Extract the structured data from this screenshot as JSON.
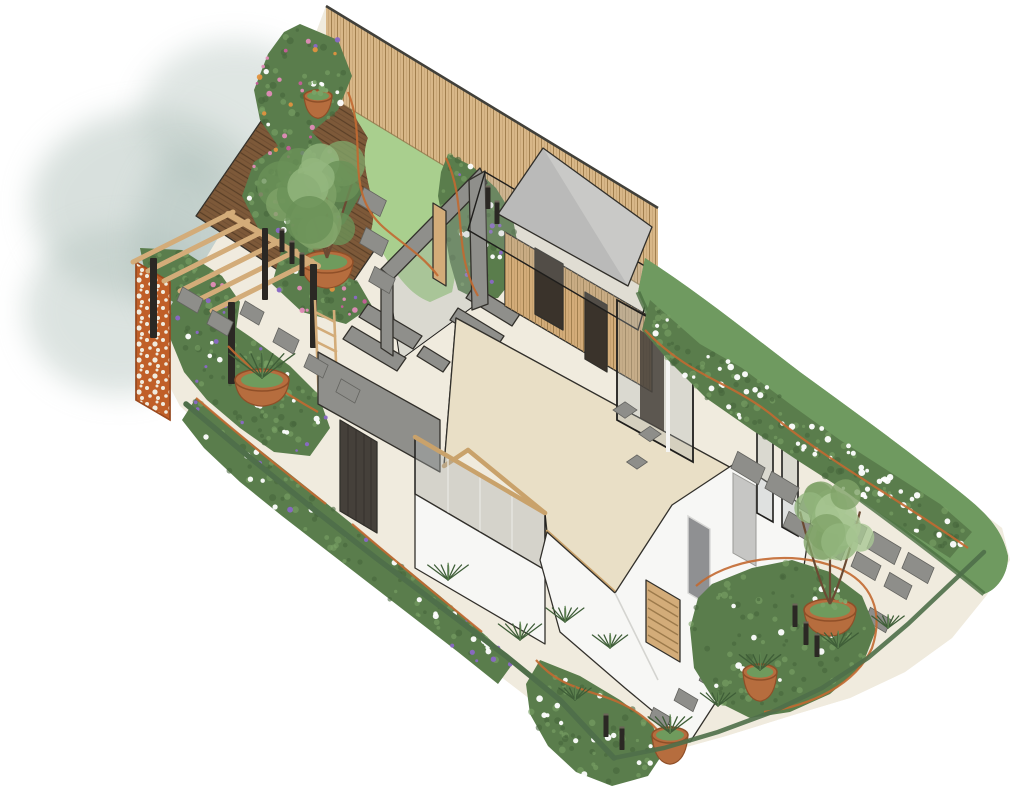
{
  "meta": {
    "title": "Axonometric garden design illustration",
    "alt": "Hand-rendered axonometric landscape plan of a long rectangular show garden with a cutaway house, herringbone-paved interior floor, timber garden building with grey canopy, timber slat fence, decked corner with pergola and corten screen, lawn, gravel paths with grey pavers, planting beds of pink, purple and white flowers, terracotta pots and a long clipped hedge"
  },
  "palette": {
    "bg": "#ffffff",
    "wash": "#b9c8c2",
    "washDark": "#9db3ad",
    "gravel": "#f0ebde",
    "speck": "#c9b795",
    "deck": "#7d5939",
    "deckLine": "#5a3f27",
    "lawn": "#a9cf8e",
    "lawnDot": "#8abc6e",
    "lawnLight": "#c8e4ab",
    "fence": "#d8b788",
    "fenceLine": "#a2804f",
    "fenceCap": "#41403a",
    "herr": "#e9dfc6",
    "herrLine": "#b2a185",
    "floorEdge": "#c9a26b",
    "white": "#f7f7f5",
    "whiteShade": "#e9e9e6",
    "outline": "#32302b",
    "gray": "#8f8f8b",
    "grayDark": "#6f6f6b",
    "darkSlat": "#45403a",
    "glass": "#a8aeae",
    "glassFrame": "#1f1e1c",
    "canopy": "#c9c9c7",
    "timber": "#d3ac79",
    "timberLine": "#9c7a4b",
    "darkDoor": "#3a332b",
    "corten": "#c05f28",
    "cortenDark": "#9c4a1e",
    "hedge": "#6f9a60",
    "hedgeDark": "#4b7042",
    "hedgeLight": "#8db377",
    "bedBase": "#5a7d4c",
    "bedDark": "#46663c",
    "bedLight": "#79a266",
    "flowerPink": "#e18cb7",
    "flowerMagenta": "#c75d99",
    "flowerPurple": "#8a68c6",
    "flowerWhite": "#ffffff",
    "flowerOrange": "#e0923f",
    "terracotta": "#b66d3e",
    "terraDark": "#8f4f28",
    "potGreen": "#6f9b5d",
    "paver": "#8e8e8a",
    "paverEdge": "#63635f",
    "bollard": "#2b2824",
    "trunk": "#6b4a33",
    "tuft": "#3f5e38",
    "edging": "#c36a31",
    "boundary": "#4f6f4a",
    "tree1": "#6a9157",
    "tree2": "#7fa268",
    "tree3": "#94b77e",
    "tree4": "#a9c793"
  },
  "scene": {
    "beds": [
      {
        "name": "bed-top-left",
        "layer": "beds-back",
        "seed": 7,
        "mottle": 130,
        "points": "300,24 338,40 352,76 338,110 312,132 340,162 362,192 344,224 308,240 322,266 358,282 372,306 346,324 302,312 272,284 282,248 258,228 242,196 254,162 278,146 260,120 254,90 268,54 284,32",
        "flowers": [
          [
            "flowerPink",
            26
          ],
          [
            "flowerMagenta",
            14
          ],
          [
            "flowerPurple",
            12
          ],
          [
            "flowerOrange",
            10
          ],
          [
            "flowerWhite",
            12
          ]
        ]
      },
      {
        "name": "bed-fence",
        "layer": "beds-back",
        "seed": 12,
        "mottle": 46,
        "points": "448,154 472,166 496,188 512,214 518,246 514,278 498,298 478,300 458,290 450,262 444,228 438,196 441,172",
        "flowers": [
          [
            "flowerPurple",
            14
          ],
          [
            "flowerWhite",
            10
          ]
        ]
      },
      {
        "name": "bed-climber",
        "layer": "beds-back",
        "seed": 3,
        "mottle": 46,
        "points": "140,248 182,250 222,276 240,302 236,330 206,322 170,300 146,278",
        "flowers": [
          [
            "flowerPink",
            5
          ],
          [
            "flowerPurple",
            4
          ]
        ]
      },
      {
        "name": "bed-left",
        "layer": "beds-back",
        "seed": 21,
        "mottle": 76,
        "points": "178,294 214,312 252,338 290,366 318,394 330,428 310,456 274,452 240,428 207,400 184,372 170,338 168,310",
        "flowers": [
          [
            "flowerPurple",
            16
          ],
          [
            "flowerWhite",
            14
          ]
        ]
      },
      {
        "name": "bed-bottom-left",
        "layer": "beds-front",
        "seed": 31,
        "mottle": 64,
        "points": "196,398 232,428 270,458 310,490 352,524 396,560 440,596 484,634 514,662 498,684 458,652 414,618 370,584 326,550 282,516 240,482 204,448 182,420",
        "flowers": [
          [
            "flowerWhite",
            18
          ],
          [
            "flowerPurple",
            12
          ]
        ]
      },
      {
        "name": "bed-bottom-center",
        "layer": "beds-front",
        "seed": 41,
        "mottle": 52,
        "points": "540,660 580,676 620,700 652,724 664,752 648,776 612,786 576,772 548,746 530,714 526,684",
        "flowers": [
          [
            "flowerWhite",
            16
          ]
        ]
      },
      {
        "name": "bed-right-hedge",
        "layer": "beds-right",
        "seed": 55,
        "mottle": 110,
        "points": "650,300 700,344 742,368 790,404 840,440 890,472 940,504 972,532 950,558 900,526 850,494 800,462 752,430 706,398 668,360 642,330",
        "flowers": [
          [
            "flowerWhite",
            64
          ]
        ]
      },
      {
        "name": "bed-right-lower",
        "layer": "beds-front",
        "seed": 61,
        "mottle": 88,
        "points": "712,584 752,568 792,560 830,572 862,596 876,630 862,666 830,694 790,712 750,718 714,700 694,668 690,628 698,598",
        "flowers": [
          [
            "flowerWhite",
            12
          ]
        ]
      }
    ],
    "trees": [
      {
        "name": "multi-stem-tree-left",
        "layer": "trees-back",
        "cx": 325,
        "cy": 194,
        "r": 57,
        "seed": 9,
        "colors": [
          "tree1",
          "tree2",
          "tree3"
        ],
        "trunkBase": [
          327,
          258
        ],
        "spread": 26
      },
      {
        "name": "multi-stem-tree-right",
        "layer": "trees-front",
        "cx": 832,
        "cy": 523,
        "r": 46,
        "seed": 17,
        "colors": [
          "tree2",
          "tree3",
          "tree4"
        ],
        "trunkBase": [
          830,
          604
        ],
        "spread": 30
      }
    ],
    "pots": [
      {
        "name": "tree-pot-left",
        "layer": "pots-back",
        "cx": 327,
        "cy": 262,
        "rx": 26,
        "ry": 11,
        "plant": "none",
        "type": "bowl"
      },
      {
        "name": "grass-pot-pergola",
        "layer": "pots-front",
        "cx": 262,
        "cy": 380,
        "rx": 27,
        "ry": 11,
        "plant": "grass",
        "type": "bowl"
      },
      {
        "name": "perennial-bowl-right",
        "layer": "pots-front",
        "cx": 830,
        "cy": 610,
        "rx": 26,
        "ry": 11,
        "plant": "perennial",
        "type": "bowl"
      },
      {
        "name": "grass-pot-right",
        "layer": "pots-front",
        "cx": 760,
        "cy": 672,
        "rx": 17,
        "ry": 8,
        "plant": "grass",
        "type": "tall"
      },
      {
        "name": "grass-pot-bottom",
        "layer": "pots-front",
        "cx": 670,
        "cy": 735,
        "rx": 18,
        "ry": 8,
        "plant": "grass",
        "type": "tall"
      },
      {
        "name": "flower-pot-fence-tip",
        "layer": "pots-back",
        "cx": 318,
        "cy": 96,
        "rx": 14,
        "ry": 6,
        "plant": "perennial",
        "type": "tall"
      }
    ],
    "pavers": [
      {
        "cx": 190,
        "cy": 300,
        "w": 24,
        "h": 15,
        "t": "u"
      },
      {
        "cx": 220,
        "cy": 323,
        "w": 24,
        "h": 15,
        "t": "u"
      },
      {
        "cx": 252,
        "cy": 313,
        "w": 22,
        "h": 14,
        "t": "u"
      },
      {
        "cx": 286,
        "cy": 341,
        "w": 24,
        "h": 15,
        "t": "u"
      },
      {
        "cx": 316,
        "cy": 366,
        "w": 22,
        "h": 14,
        "t": "u"
      },
      {
        "cx": 348,
        "cy": 391,
        "w": 22,
        "h": 14,
        "t": "u"
      },
      {
        "cx": 372,
        "cy": 202,
        "w": 26,
        "h": 17,
        "t": "u"
      },
      {
        "cx": 374,
        "cy": 242,
        "w": 26,
        "h": 17,
        "t": "u"
      },
      {
        "cx": 382,
        "cy": 280,
        "w": 24,
        "h": 16,
        "t": "u"
      },
      {
        "cx": 625,
        "cy": 410,
        "w": 15,
        "h": 15,
        "t": "d"
      },
      {
        "cx": 650,
        "cy": 434,
        "w": 14,
        "h": 14,
        "t": "d"
      },
      {
        "cx": 637,
        "cy": 462,
        "w": 13,
        "h": 13,
        "t": "d"
      },
      {
        "cx": 748,
        "cy": 468,
        "w": 32,
        "h": 18,
        "t": "u"
      },
      {
        "cx": 782,
        "cy": 488,
        "w": 32,
        "h": 18,
        "t": "u"
      },
      {
        "cx": 816,
        "cy": 508,
        "w": 32,
        "h": 18,
        "t": "u"
      },
      {
        "cx": 850,
        "cy": 528,
        "w": 32,
        "h": 18,
        "t": "u"
      },
      {
        "cx": 884,
        "cy": 548,
        "w": 32,
        "h": 18,
        "t": "u"
      },
      {
        "cx": 918,
        "cy": 568,
        "w": 30,
        "h": 17,
        "t": "u"
      },
      {
        "cx": 798,
        "cy": 526,
        "w": 28,
        "h": 16,
        "t": "u"
      },
      {
        "cx": 832,
        "cy": 546,
        "w": 28,
        "h": 16,
        "t": "u"
      },
      {
        "cx": 866,
        "cy": 566,
        "w": 28,
        "h": 16,
        "t": "u"
      },
      {
        "cx": 898,
        "cy": 586,
        "w": 26,
        "h": 15,
        "t": "u"
      },
      {
        "cx": 846,
        "cy": 604,
        "w": 26,
        "h": 15,
        "t": "u"
      },
      {
        "cx": 878,
        "cy": 620,
        "w": 24,
        "h": 14,
        "t": "u"
      },
      {
        "cx": 737,
        "cy": 658,
        "w": 24,
        "h": 14,
        "t": "u"
      },
      {
        "cx": 712,
        "cy": 680,
        "w": 24,
        "h": 14,
        "t": "u"
      },
      {
        "cx": 686,
        "cy": 700,
        "w": 22,
        "h": 13,
        "t": "u"
      },
      {
        "cx": 660,
        "cy": 718,
        "w": 20,
        "h": 12,
        "t": "u"
      }
    ],
    "bollards": [
      [
        282,
        250
      ],
      [
        292,
        262
      ],
      [
        302,
        274
      ],
      [
        488,
        207
      ],
      [
        497,
        222
      ],
      [
        606,
        735
      ],
      [
        622,
        748
      ],
      [
        795,
        625
      ],
      [
        806,
        643
      ],
      [
        817,
        655
      ]
    ],
    "tufts": [
      [
        448,
        580,
        15
      ],
      [
        520,
        640,
        16
      ],
      [
        565,
        622,
        14
      ],
      [
        610,
        648,
        13
      ],
      [
        838,
        648,
        15
      ],
      [
        718,
        706,
        13
      ],
      [
        888,
        628,
        12
      ],
      [
        575,
        700,
        12
      ]
    ],
    "edging_paths": [
      "M348,92 C368,140 344,188 380,224 C396,240 420,252 438,276",
      "M446,158 C468,204 452,252 478,296",
      "M645,330 C690,378 734,382 778,420 C830,462 900,500 968,548",
      "M536,660 C566,696 606,688 642,716 C658,728 668,742 672,756",
      "M696,586 C726,560 790,548 838,568 C872,582 884,612 872,648 C856,684 812,706 764,712",
      "M196,398 C238,434 282,470 326,504",
      "M352,524 C394,560 438,596 482,632",
      "M228,346 C252,372 286,394 318,412"
    ]
  }
}
